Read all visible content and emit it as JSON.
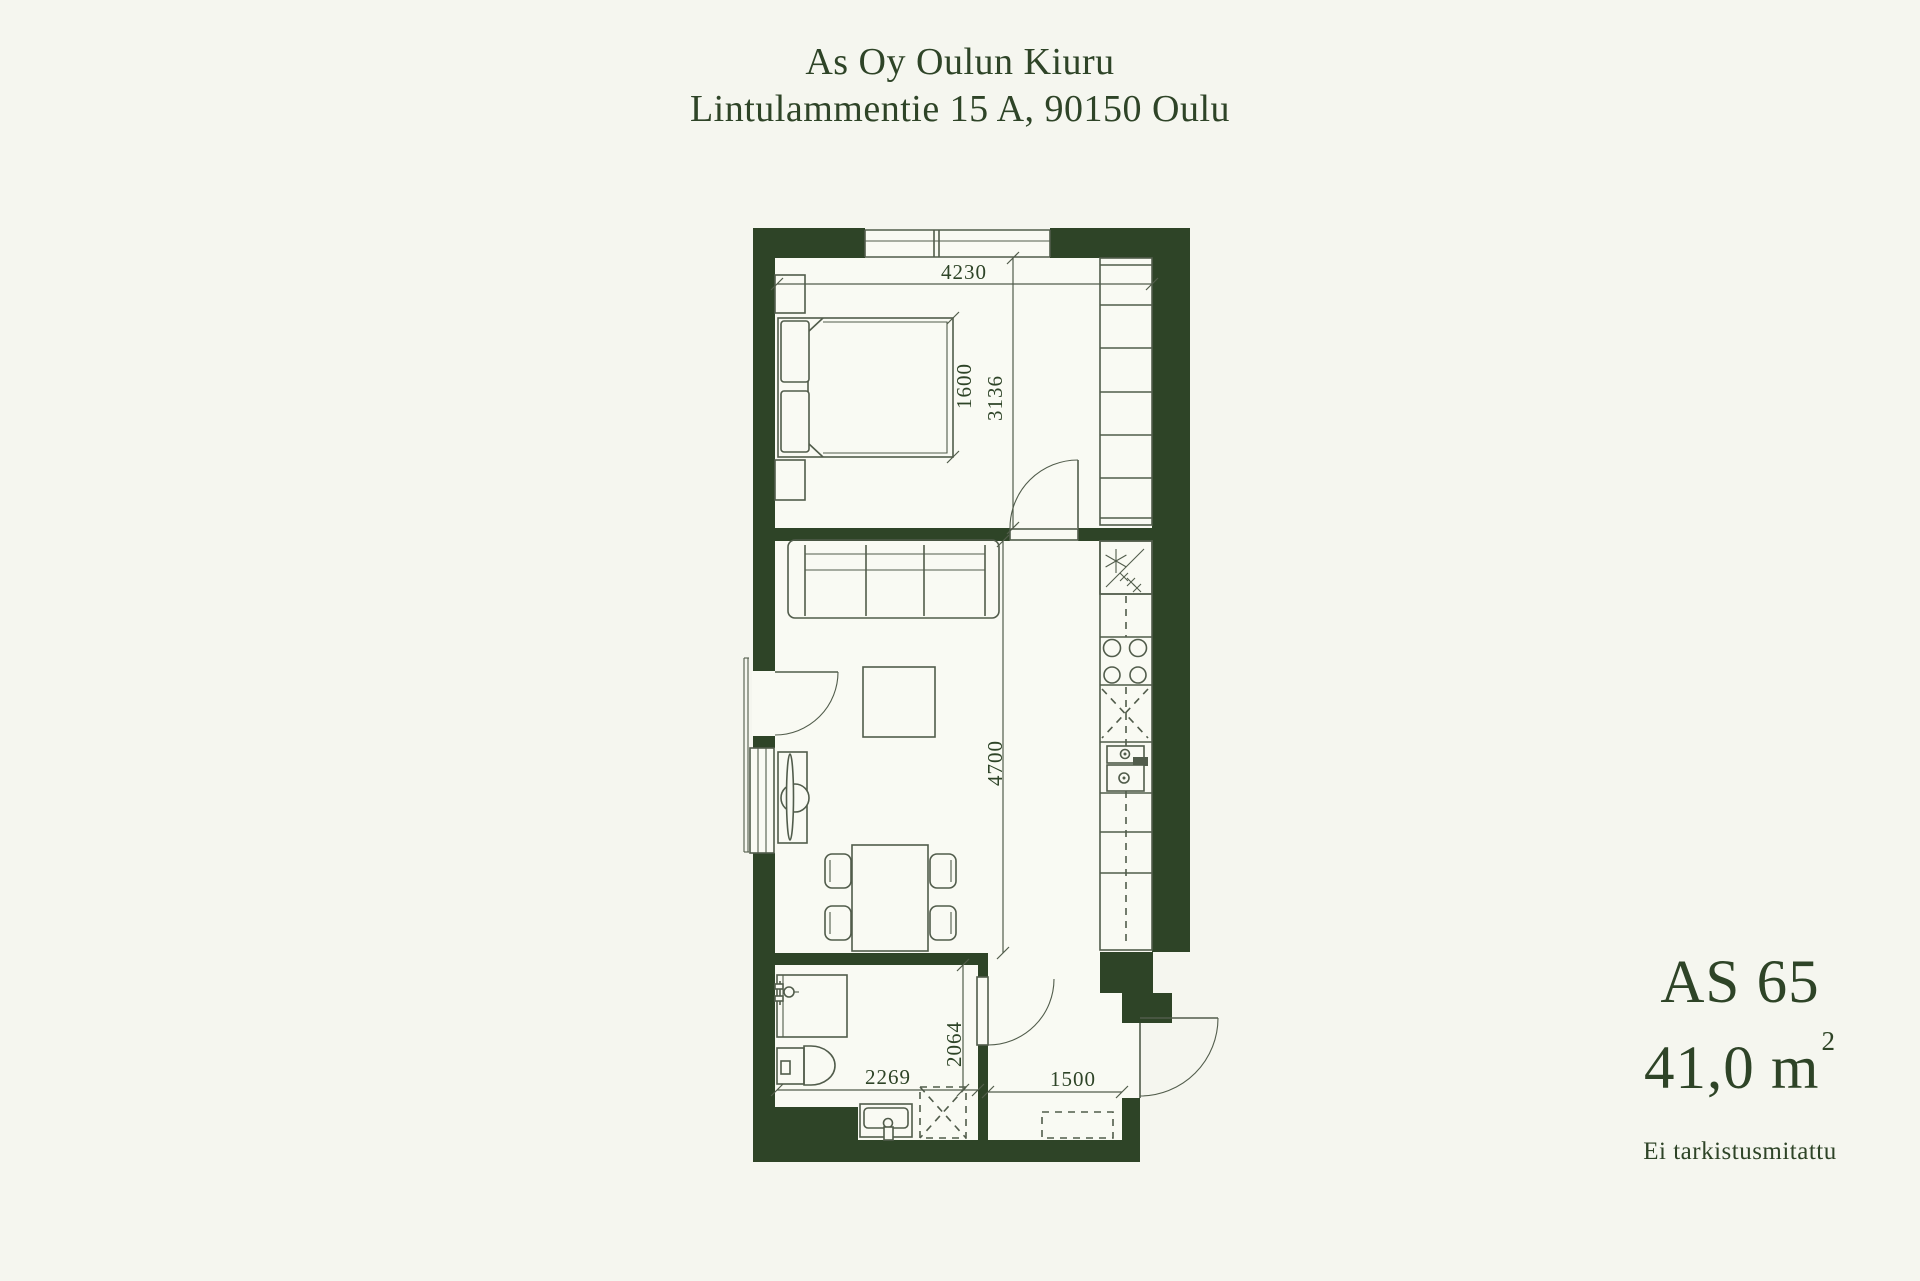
{
  "header": {
    "title": "As Oy Oulun Kiuru",
    "address": "Lintulammentie 15 A, 90150 Oulu"
  },
  "unit": {
    "id": "AS 65",
    "area": "41,0 m",
    "area_superscript": "2",
    "note": "Ei tarkistusmitattu"
  },
  "dimensions": {
    "bedroom_width": "4230",
    "bed_width": "1600",
    "bedroom_depth": "3136",
    "living_depth": "4700",
    "bathroom_width": "2269",
    "bathroom_depth": "2064",
    "hallway_width": "1500"
  },
  "colors": {
    "background": "#f5f6ef",
    "floor": "#f9faf3",
    "wall": "#2e4427",
    "line": "#515c4b",
    "text": "#2e4427"
  }
}
